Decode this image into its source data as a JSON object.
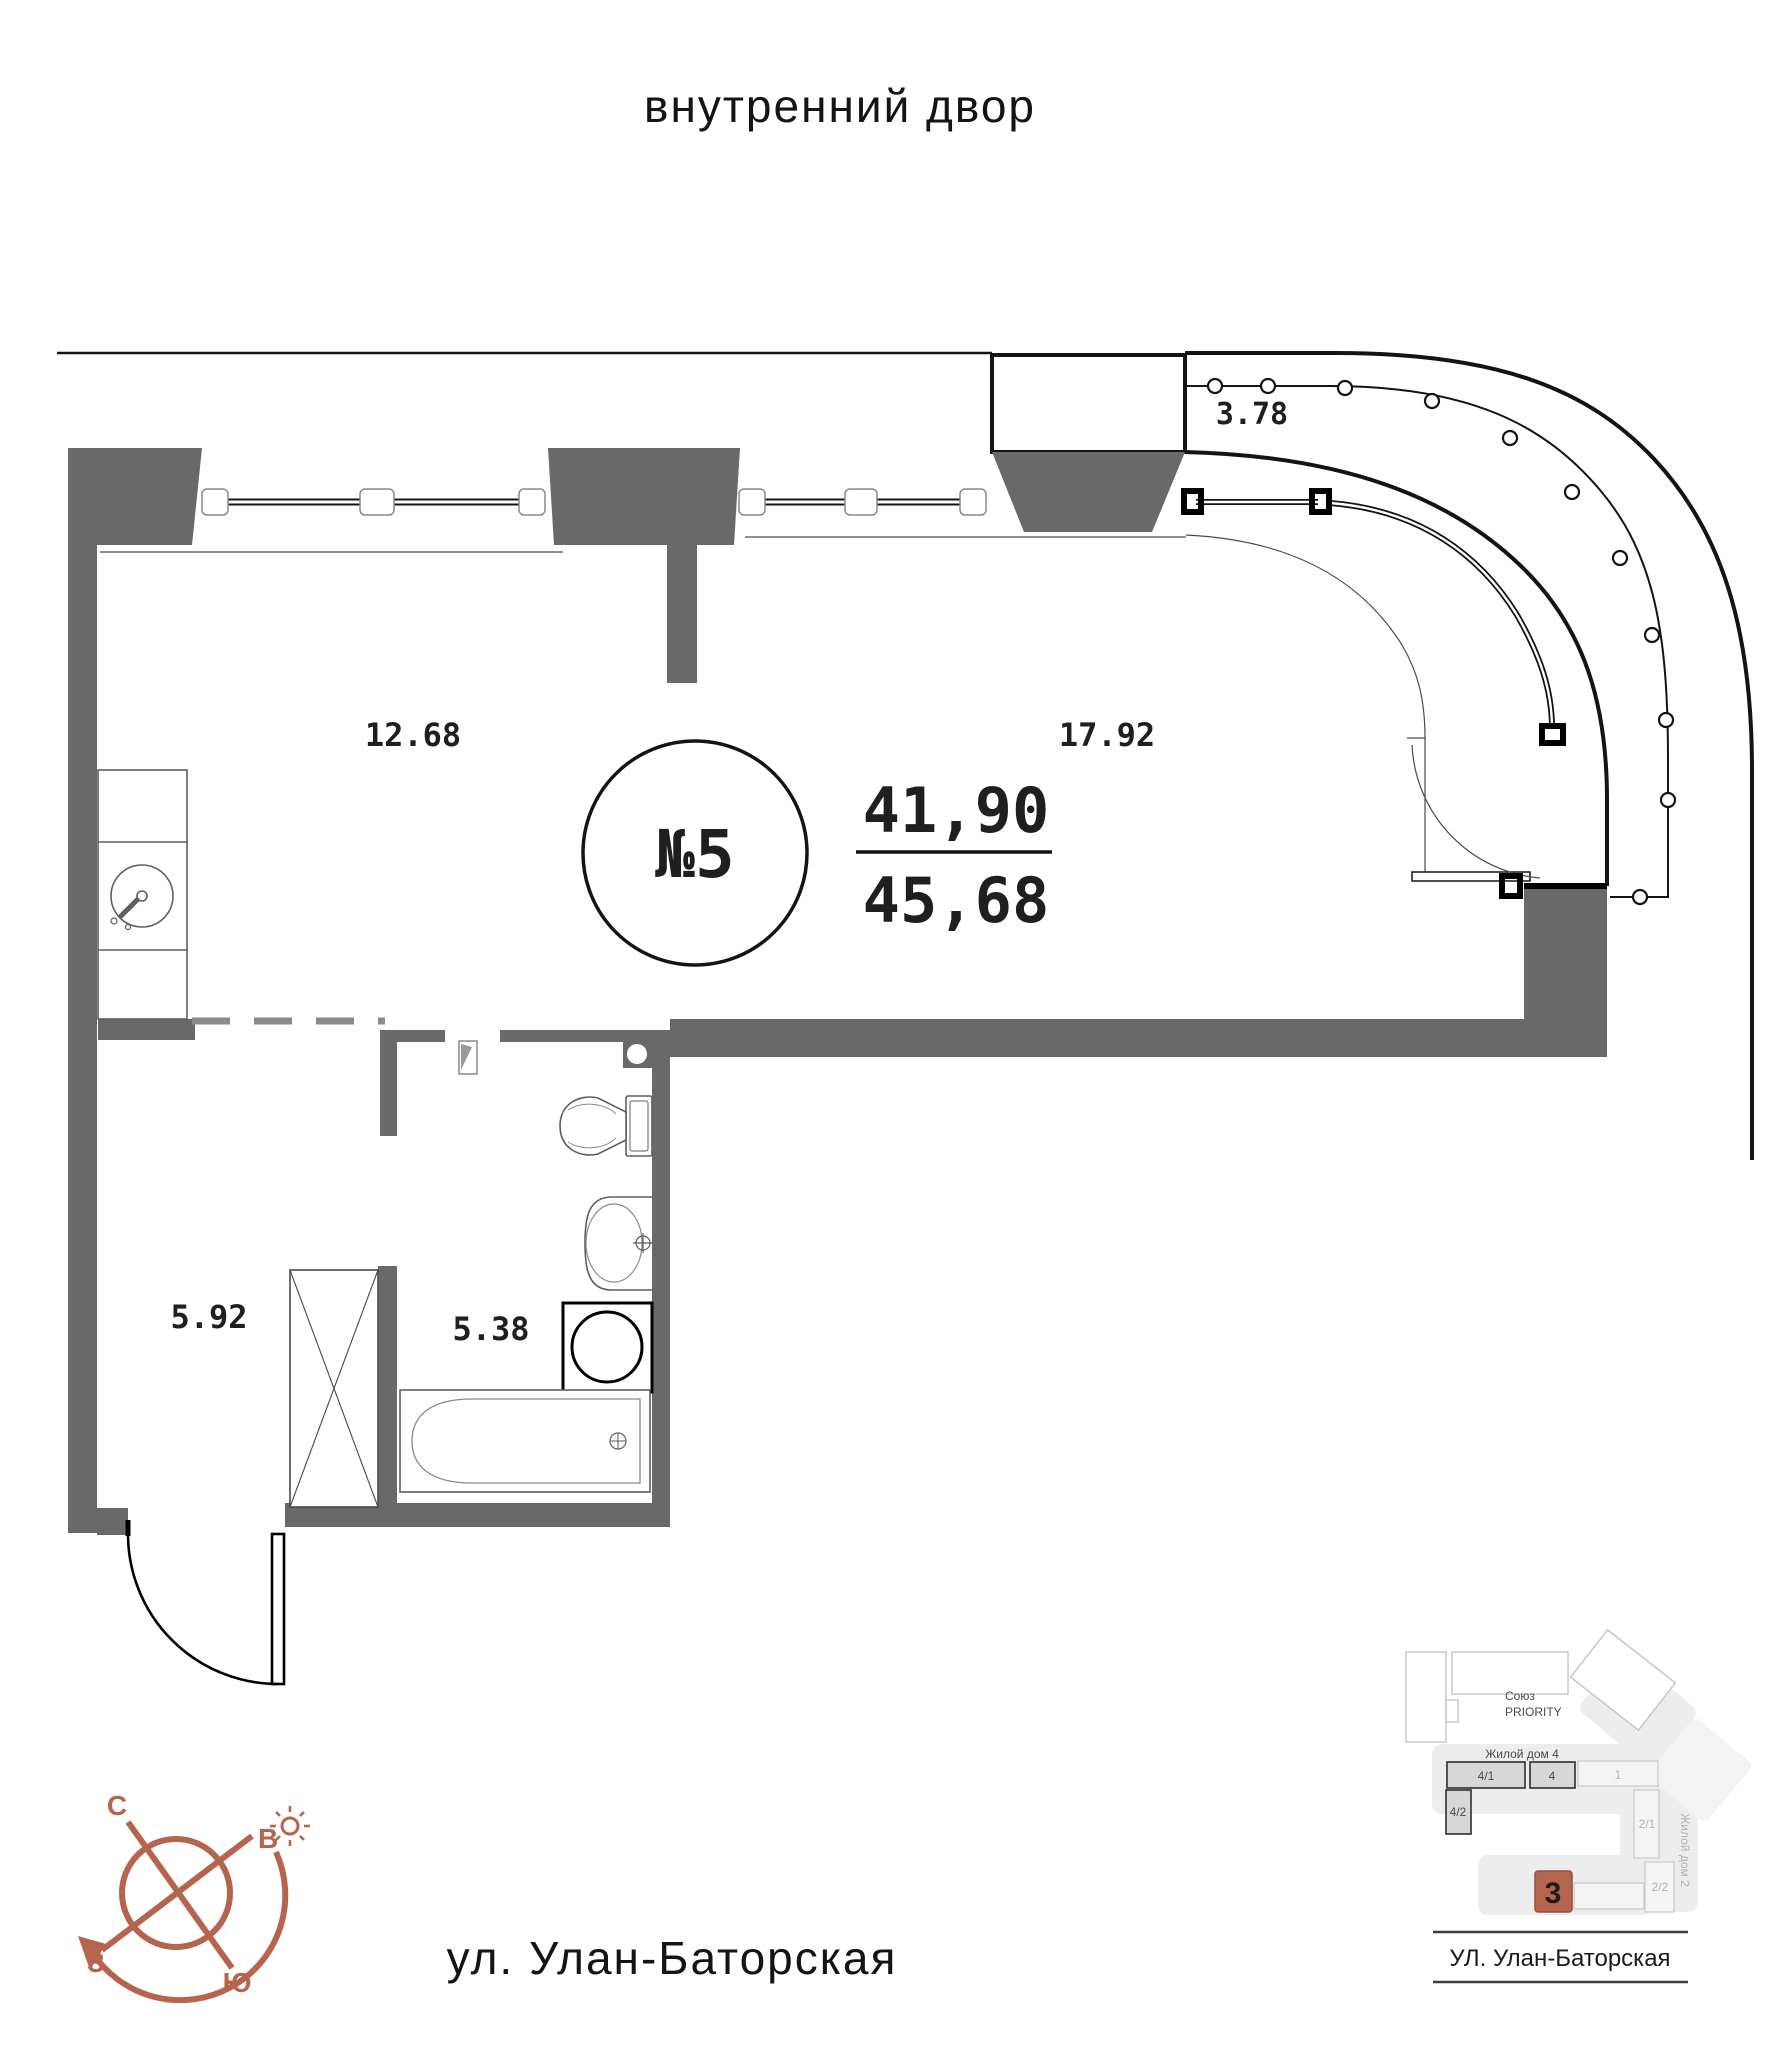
{
  "page": {
    "courtyard_label": "внутренний двор",
    "street_label": "ул. Улан-Баторская"
  },
  "apartment": {
    "number_label": "№5",
    "living_area": "41,90",
    "total_area": "45,68",
    "rooms": {
      "kitchen": "12.68",
      "living": "17.92",
      "balcony": "3.78",
      "hall": "5.92",
      "bathroom": "5.38"
    }
  },
  "compass": {
    "north": "С",
    "east": "В",
    "west": "З",
    "south": "Ю"
  },
  "minimap": {
    "complex_line1": "Союз",
    "complex_line2": "PRIORITY",
    "house4_label": "Жилой дом 4",
    "house2_label": "Жилой дом 2",
    "blocks": {
      "b41": "4/1",
      "b4": "4",
      "b1": "1",
      "b42": "4/2",
      "b21": "2/1",
      "b22": "2/2"
    },
    "current_block": "3",
    "street_label": "УЛ. Улан-Баторская"
  },
  "colors": {
    "wall": "#696969",
    "accent": "#b5644e",
    "line": "#141414"
  }
}
